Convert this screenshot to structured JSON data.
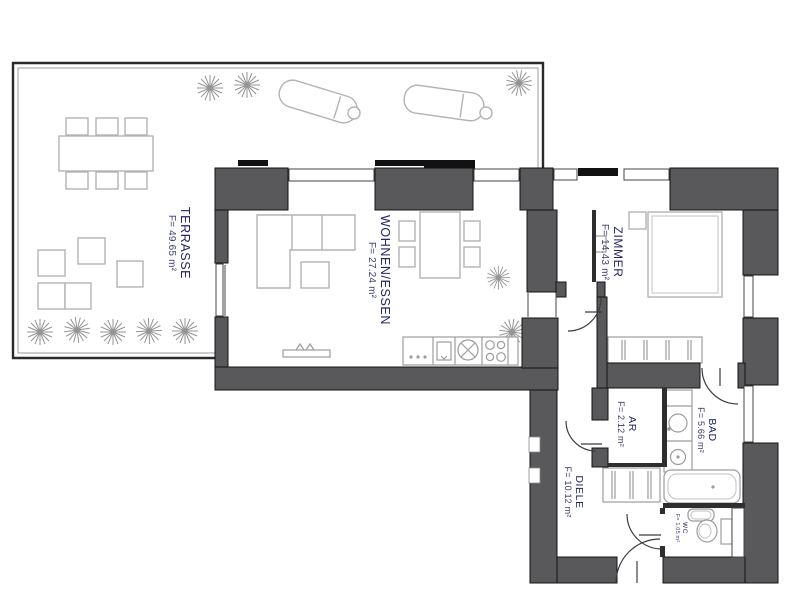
{
  "floorplan": {
    "title": "apartment-floor-plan",
    "rooms": [
      {
        "name": "TERRASSE",
        "area": "F= 49.65 m²"
      },
      {
        "name": "WOHNEN/ESSEN",
        "area": "F= 27.24 m²"
      },
      {
        "name": "ZIMMER",
        "area": "F= 14.43 m²"
      },
      {
        "name": "AR",
        "area": "F= 2.12 m²"
      },
      {
        "name": "BAD",
        "area": "F= 5.66 m²"
      },
      {
        "name": "DIELE",
        "area": "F= 10.12 m²"
      },
      {
        "name": "WC",
        "area": "F= 1.05 m²"
      }
    ],
    "colors": {
      "wall": "#59595b",
      "thin": "#2e2e2e",
      "furn": "#b3b3b3",
      "fixture": "#9c9c9c",
      "door": "#3c3c3c",
      "label_name": "#232366",
      "label_area": "#3c3c70",
      "plant": "#949494",
      "border_outer": "#2a2a2a",
      "border_inner": "#9a9a9a",
      "frame": "#444444"
    }
  }
}
